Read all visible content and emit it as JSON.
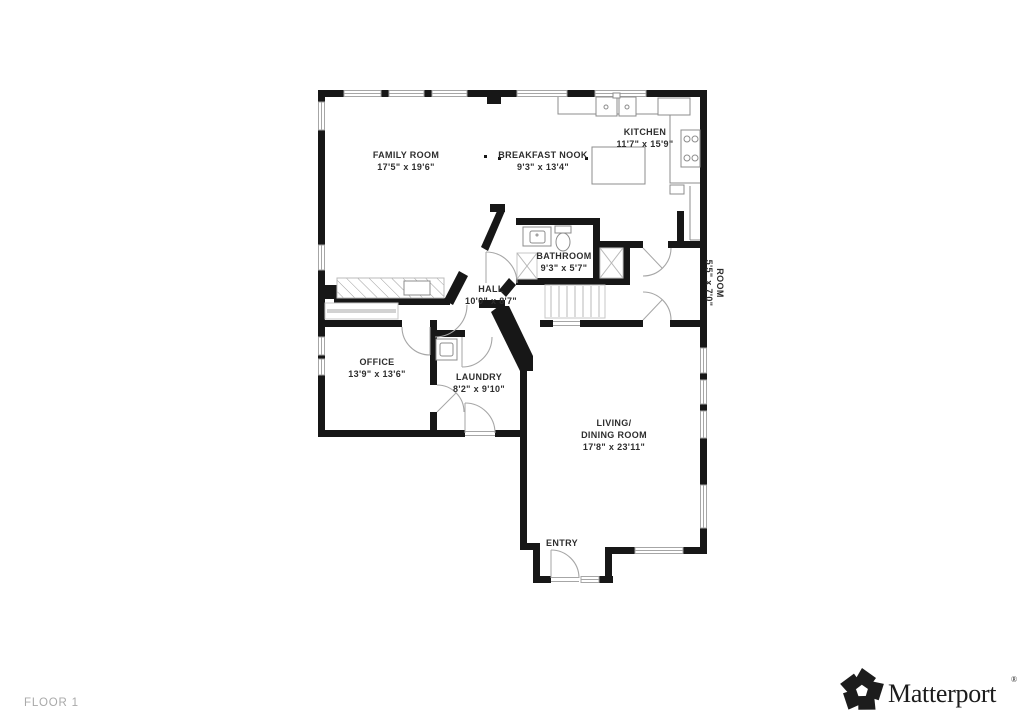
{
  "page": {
    "floor_label": "FLOOR 1"
  },
  "brand": {
    "wordmark": "Matterport",
    "registered_mark": "®",
    "logo_icon": "matterport-pinwheel-icon"
  },
  "rooms": {
    "family_room": {
      "name": "FAMILY ROOM",
      "dims": "17'5\" x 19'6\""
    },
    "breakfast_nook": {
      "name": "BREAKFAST NOOK",
      "dims": "9'3\" x 13'4\""
    },
    "kitchen": {
      "name": "KITCHEN",
      "dims": "11'7\" x 15'9\""
    },
    "bathroom": {
      "name": "BATHROOM",
      "dims": "9'3\" x 5'7\""
    },
    "hall": {
      "name": "HALL",
      "dims": "10'0\" x 8'7\""
    },
    "office": {
      "name": "OFFICE",
      "dims": "13'9\" x 13'6\""
    },
    "laundry": {
      "name": "LAUNDRY",
      "dims": "8'2\" x 9'10\""
    },
    "living_dining": {
      "name_line_1": "LIVING/",
      "name_line_2": "DINING ROOM",
      "dims": "17'8\" x 23'11\""
    },
    "entry": {
      "name": "ENTRY"
    },
    "side_room": {
      "name": "ROOM",
      "dims": "5'5\" x 7'0\""
    }
  },
  "colors": {
    "wall": "#171717",
    "window_line": "#a6a6a6",
    "fixture_line": "#8c8c8c",
    "label_text": "#2e2e2e",
    "floor_label_text": "#a9a9a9",
    "brand_text": "#1c1c1c"
  }
}
